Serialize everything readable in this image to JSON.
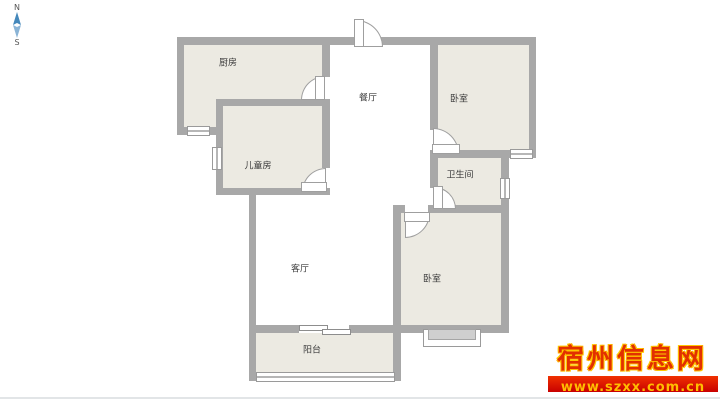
{
  "compass": {
    "north_label": "N",
    "south_label": "S",
    "needle_top_color": "#4488bb",
    "needle_bottom_color": "#8ab4d6"
  },
  "rooms": {
    "kitchen": {
      "label": "厨房"
    },
    "dining": {
      "label": "餐厅"
    },
    "bedroom_top": {
      "label": "卧室"
    },
    "children_room": {
      "label": "儿童房"
    },
    "bathroom": {
      "label": "卫生间"
    },
    "living_room": {
      "label": "客厅"
    },
    "bedroom_bottom": {
      "label": "卧室"
    },
    "balcony": {
      "label": "阳台"
    }
  },
  "watermark": {
    "site_name": "宿州信息网",
    "site_url": "www.szxx.com.cn",
    "name_color": "#e23000",
    "banner_color": "#d40000",
    "url_color": "#ffbe00"
  },
  "colors": {
    "wall": "#a8a8a8",
    "room_fill": "#eceae2",
    "background": "#ffffff"
  }
}
